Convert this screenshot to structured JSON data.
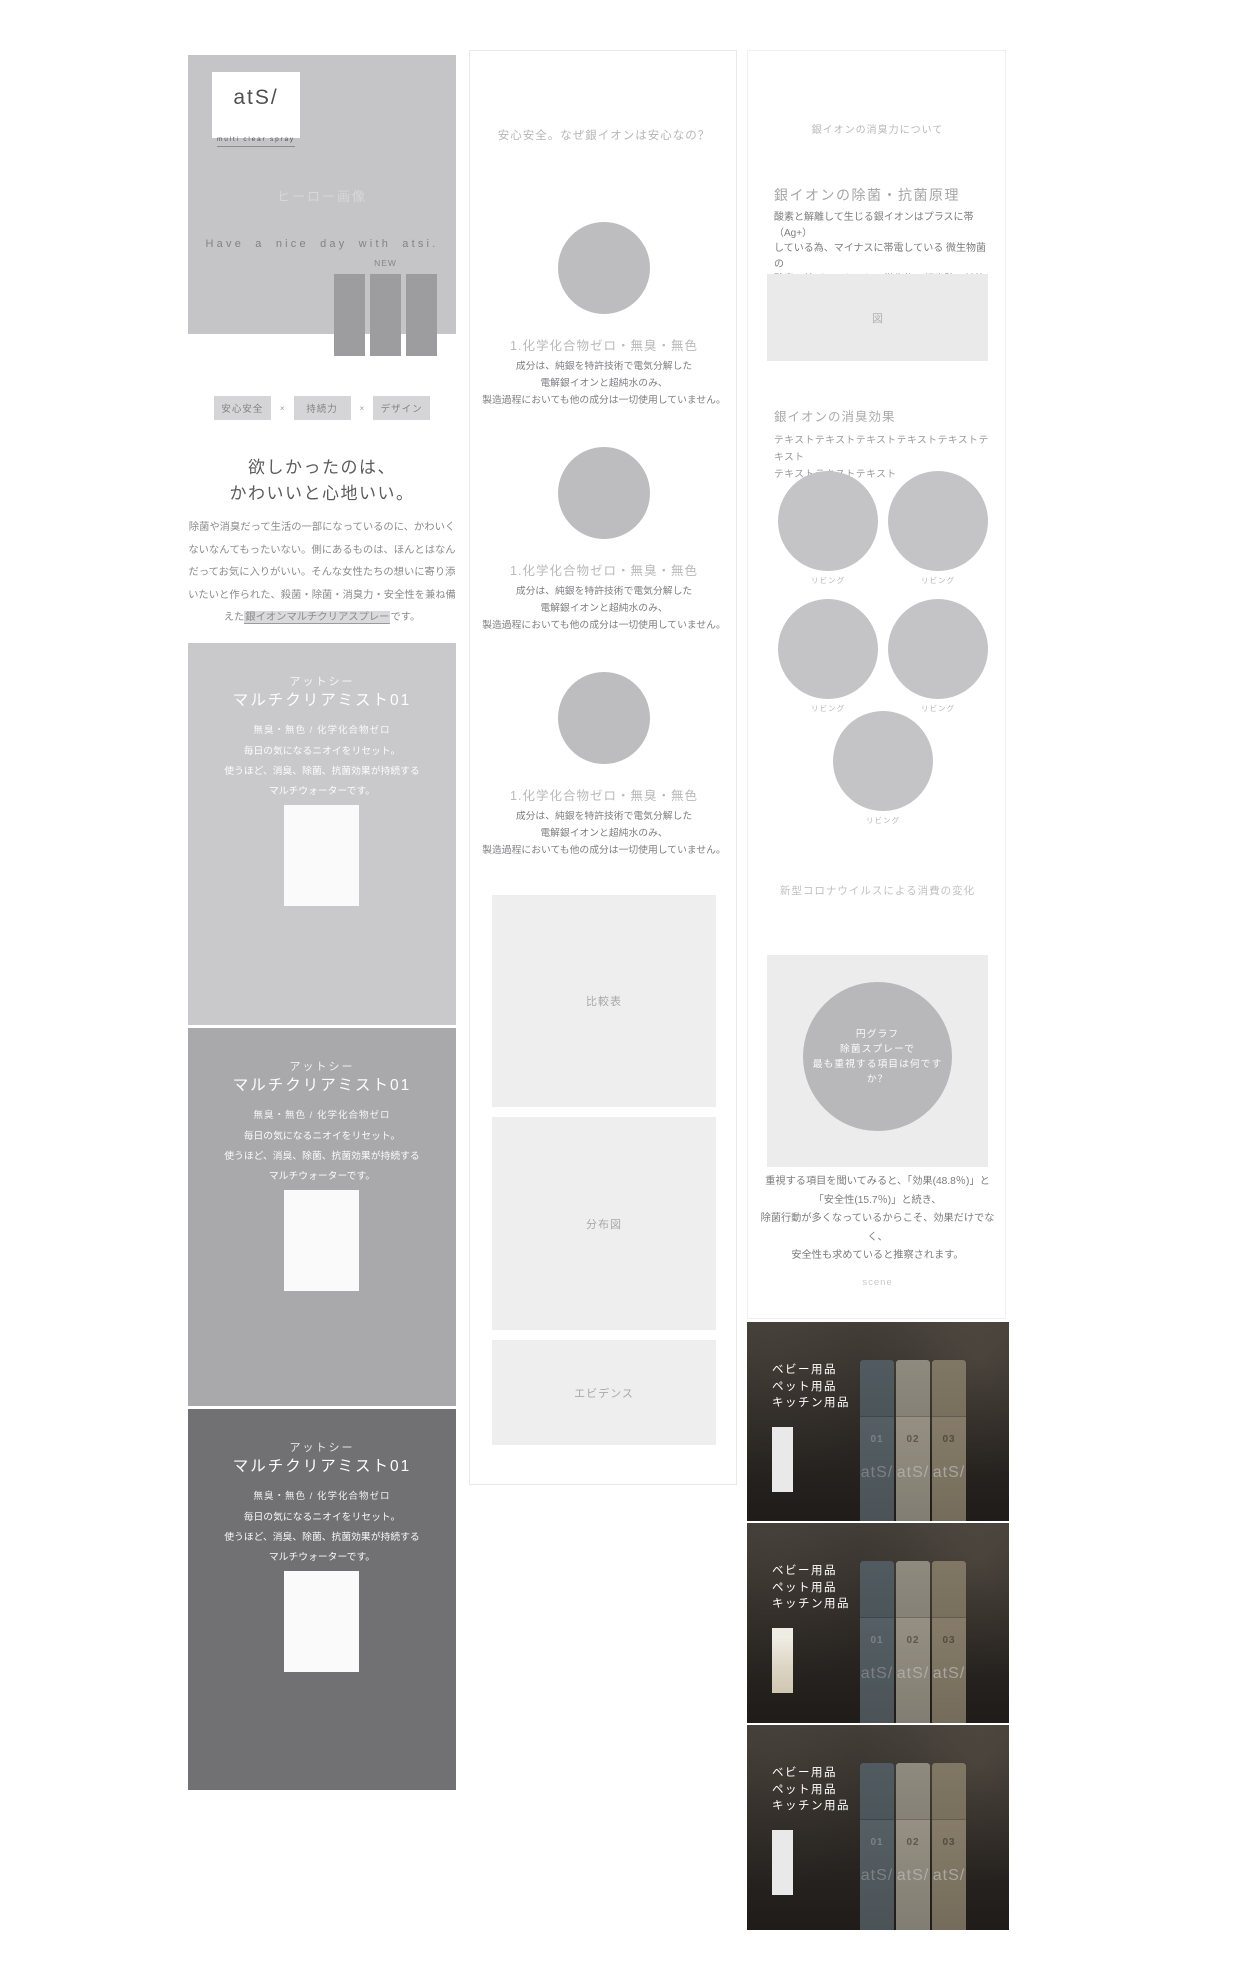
{
  "colors": {
    "card1": "#c9c9cb",
    "card2": "#a9a9ab",
    "card3": "#717173"
  },
  "page1": {
    "hero": {
      "logo_title": "atS/",
      "logo_subtitle": "multi clear spray",
      "placeholder": "ヒーロー画像",
      "tagline": "Have a nice day with atsi.",
      "new_label": "NEW"
    },
    "concept": {
      "tags": [
        "安心安全",
        "持続力",
        "デザイン"
      ],
      "separator": "×",
      "heading1": "欲しかったのは、",
      "heading2": "かわいいと心地いい。",
      "body_lines": [
        "除菌や消臭だって生活の一部になっているのに、かわいく",
        "ないなんてもったいない。側にあるものは、ほんとはなん",
        "だってお気に入りがいい。そんな女性たちの想いに寄り添",
        "いたいと作られた、殺菌・除菌・消臭力・安全性を兼ね備"
      ],
      "body5_pre": "えた",
      "body5_mark": "銀イオンマルチクリアスプレー",
      "body5_post": "です。"
    },
    "products": [
      {
        "brand": "アットシー",
        "name": "マルチクリアミスト01",
        "spec": "無臭・無色 / 化学化合物ゼロ",
        "desc1": "毎日の気になるニオイをリセット。",
        "desc2": "使うほど、消臭、除菌、抗菌効果が持続する",
        "desc3": "マルチウォーターです。"
      },
      {
        "brand": "アットシー",
        "name": "マルチクリアミスト01",
        "spec": "無臭・無色 / 化学化合物ゼロ",
        "desc1": "毎日の気になるニオイをリセット。",
        "desc2": "使うほど、消臭、除菌、抗菌効果が持続する",
        "desc3": "マルチウォーターです。"
      },
      {
        "brand": "アットシー",
        "name": "マルチクリアミスト01",
        "spec": "無臭・無色 / 化学化合物ゼロ",
        "desc1": "毎日の気になるニオイをリセット。",
        "desc2": "使うほど、消臭、除菌、抗菌効果が持続する",
        "desc3": "マルチウォーターです。"
      }
    ]
  },
  "page2": {
    "title": "安心安全。なぜ銀イオンは安心なの？",
    "features": [
      {
        "heading": "1.化学化合物ゼロ・無臭・無色",
        "line1": "成分は、純銀を特許技術で電気分解した",
        "line2": "電解銀イオンと超純水のみ、",
        "line3": "製造過程においても他の成分は一切使用していません。"
      },
      {
        "heading": "1.化学化合物ゼロ・無臭・無色",
        "line1": "成分は、純銀を特許技術で電気分解した",
        "line2": "電解銀イオンと超純水のみ、",
        "line3": "製造過程においても他の成分は一切使用していません。"
      },
      {
        "heading": "1.化学化合物ゼロ・無臭・無色",
        "line1": "成分は、純銀を特許技術で電気分解した",
        "line2": "電解銀イオンと超純水のみ、",
        "line3": "製造過程においても他の成分は一切使用していません。"
      }
    ],
    "boxes": [
      "比較表",
      "分布図",
      "エビデンス"
    ]
  },
  "page3": {
    "top_title": "銀イオンの消臭力について",
    "principle": {
      "heading": "銀イオンの除菌・抗菌原理",
      "line1": "酸素と解離して生じる銀イオンはプラスに帯（Ag+）",
      "line2": "している為、マイナスに帯電している 微生物菌の",
      "line3": "酸素と結びつこうとし、微生物の細胞壁に付着し、",
      "line4": "細胞壁が破壊されて死滅（殺菌作用）します。",
      "figure_label": "図"
    },
    "deodorize": {
      "heading": "銀イオンの消臭効果",
      "line1": "テキストテキストテキストテキストテキストテキスト",
      "line2": "テキストテキストテキスト"
    },
    "scene_label": "リビング",
    "survey": {
      "title": "新型コロナウイルスによる消費の変化",
      "pie1": "円グラフ",
      "pie2": "除菌スプレーで",
      "pie3": "最も重視する項目は何ですか？",
      "line1": "重視する項目を聞いてみると、「効果(48.8％)」と",
      "line2": "「安全性(15.7％)」と続き、",
      "line3": "除菌行動が多くなっているからこそ、効果だけでなく、",
      "line4": "安全性も求めていると推察されます。"
    },
    "scene_footer": "scene",
    "categories": [
      "ベビー用品",
      "ペット用品",
      "キッチン用品"
    ],
    "bottles": [
      "01",
      "02",
      "03"
    ],
    "bottle_logo": "atS/"
  }
}
